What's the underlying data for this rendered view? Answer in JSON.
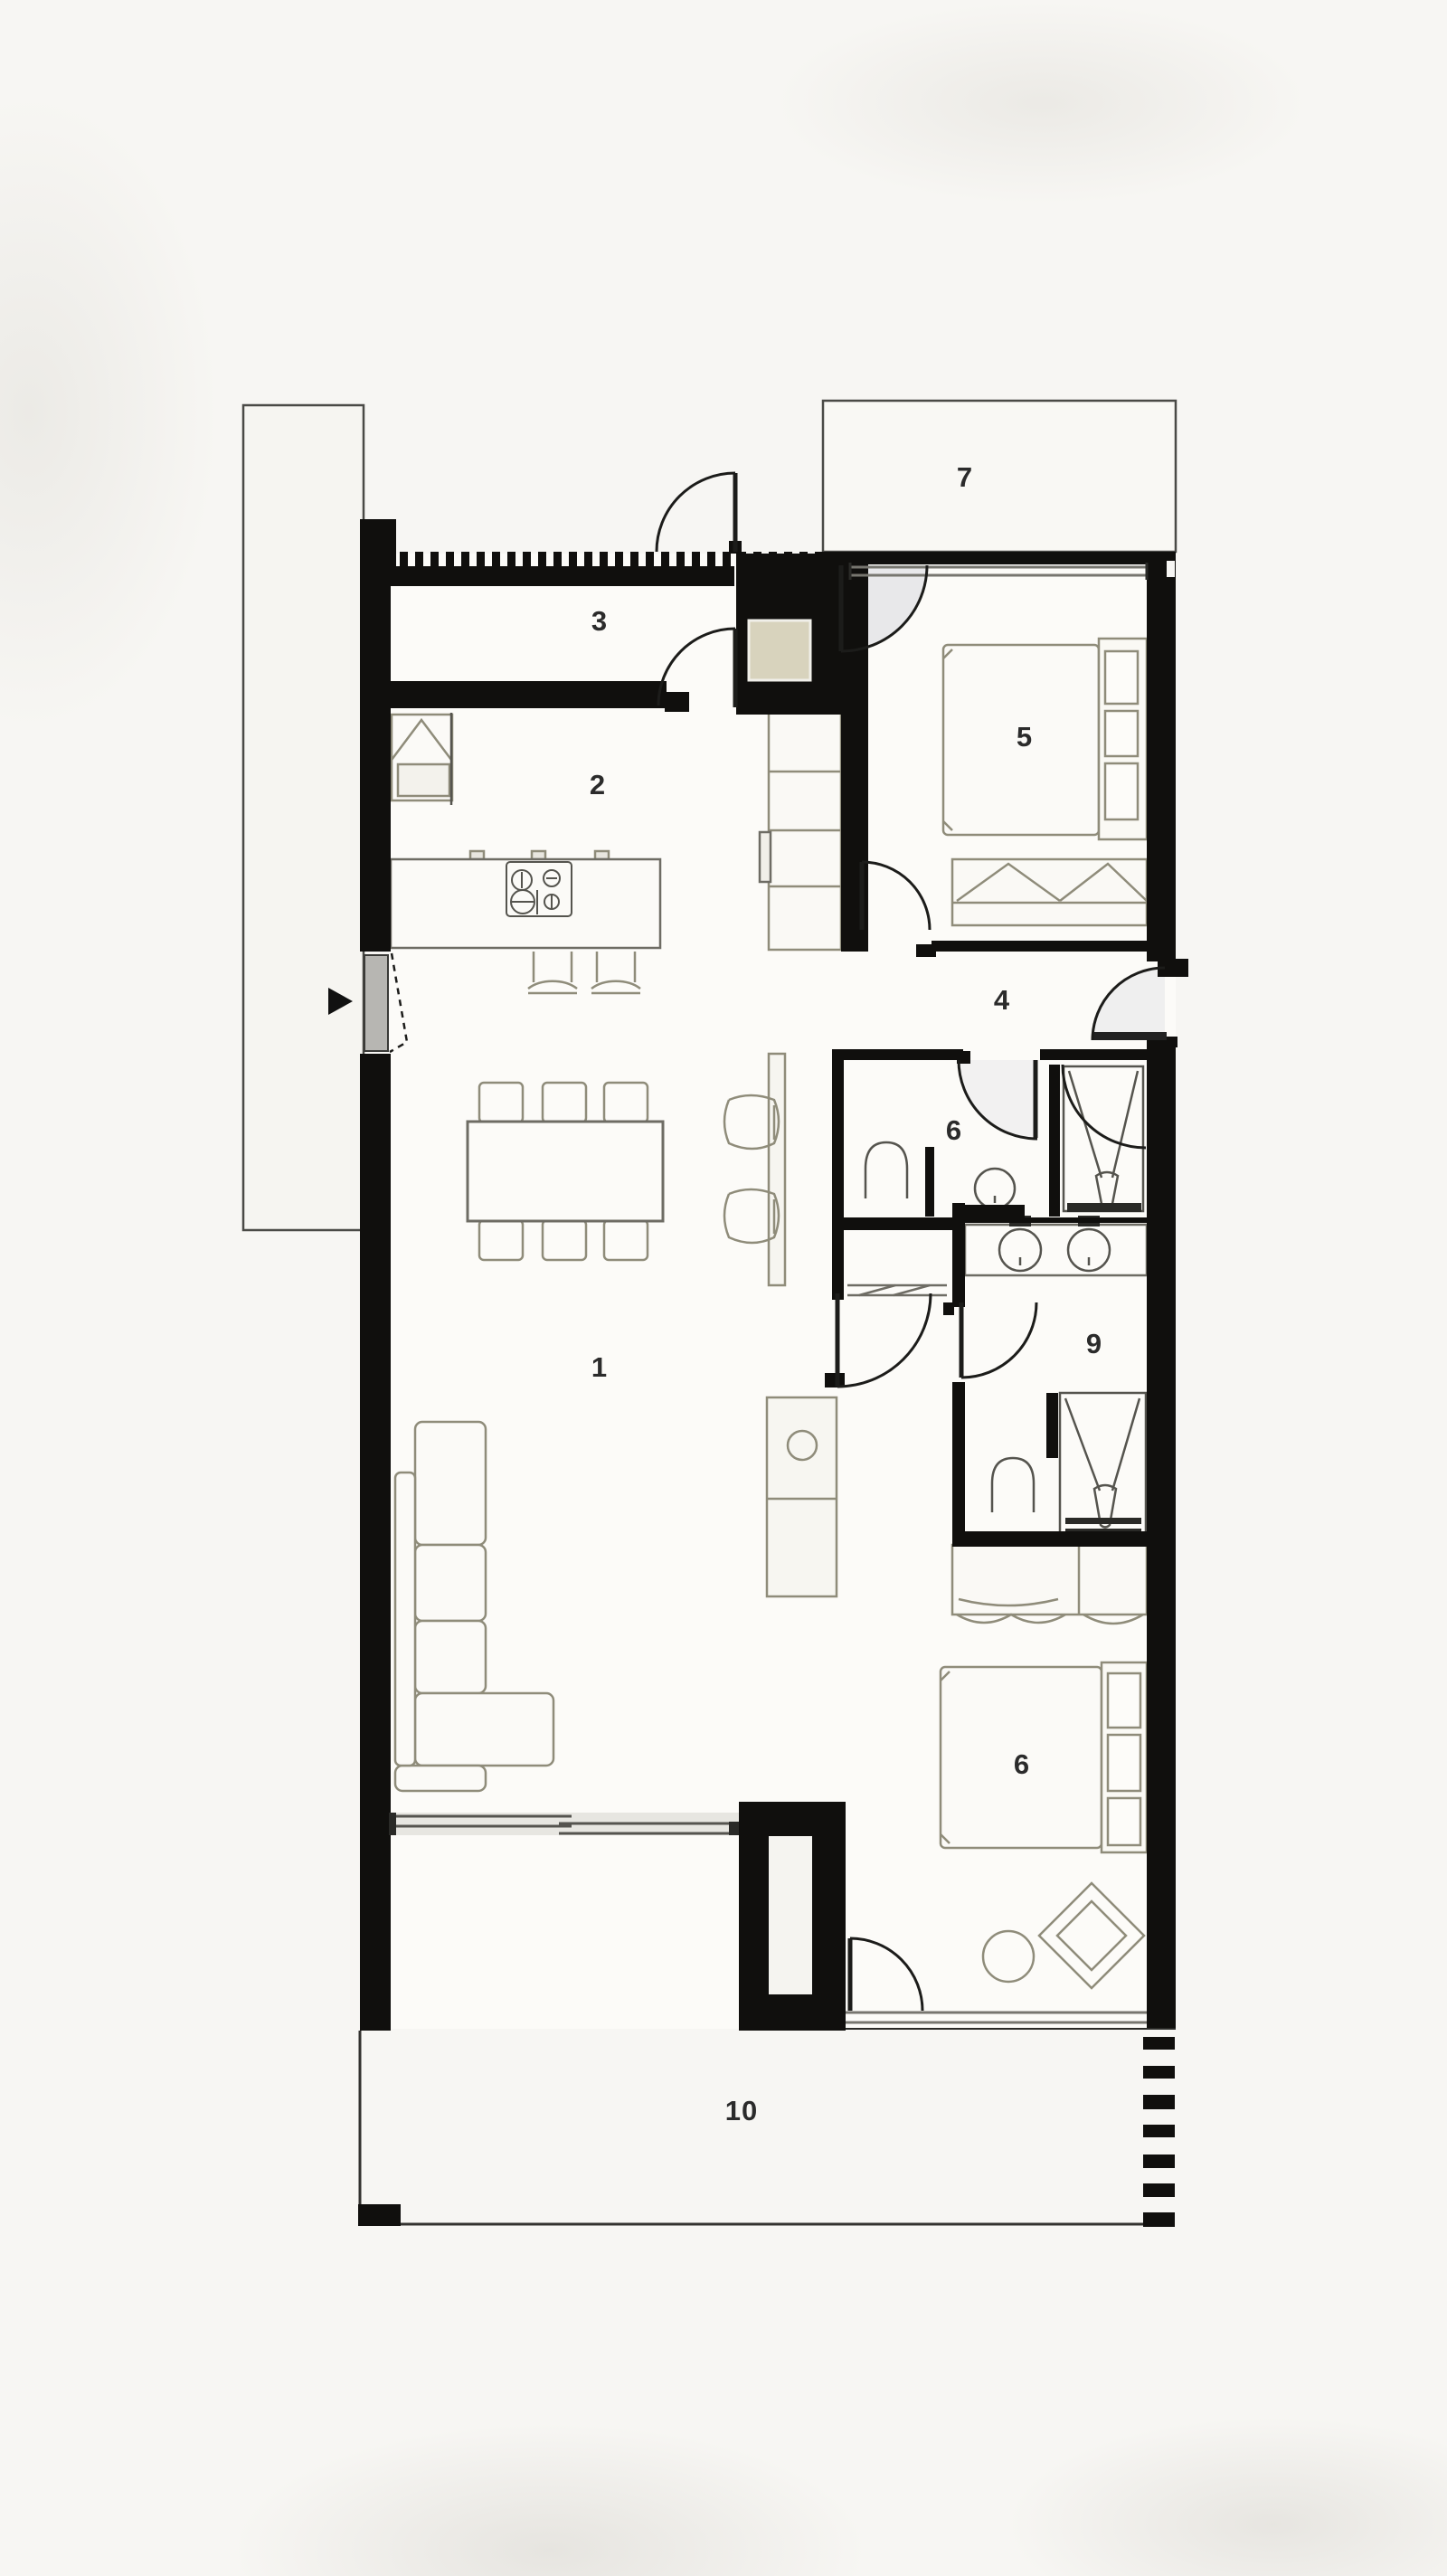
{
  "meta": {
    "title": "Apartment floor plan",
    "drawing_type": "architectural plan, black and white",
    "entry_arrow": "west side entry marker"
  },
  "colors": {
    "background": "#f7f6f3",
    "wall": "#100f0d",
    "thin_line": "#3c3b38",
    "furniture_line": "#8f8c7a",
    "window_line": "#77766f",
    "niche_tan": "#d8d3bd",
    "door_swing_fill": "#e8e8ea",
    "label_text": "#2b2b2b"
  },
  "rooms": [
    {
      "id": "living-dining",
      "label": "1"
    },
    {
      "id": "kitchen",
      "label": "2"
    },
    {
      "id": "entry-corridor",
      "label": "3"
    },
    {
      "id": "hallway",
      "label": "4"
    },
    {
      "id": "bedroom-north",
      "label": "5"
    },
    {
      "id": "bathroom",
      "label": "6"
    },
    {
      "id": "terrace-north",
      "label": "7"
    },
    {
      "id": "bedroom-south",
      "label": "6"
    },
    {
      "id": "ensuite",
      "label": "9"
    },
    {
      "id": "terrace-south",
      "label": "10"
    }
  ]
}
